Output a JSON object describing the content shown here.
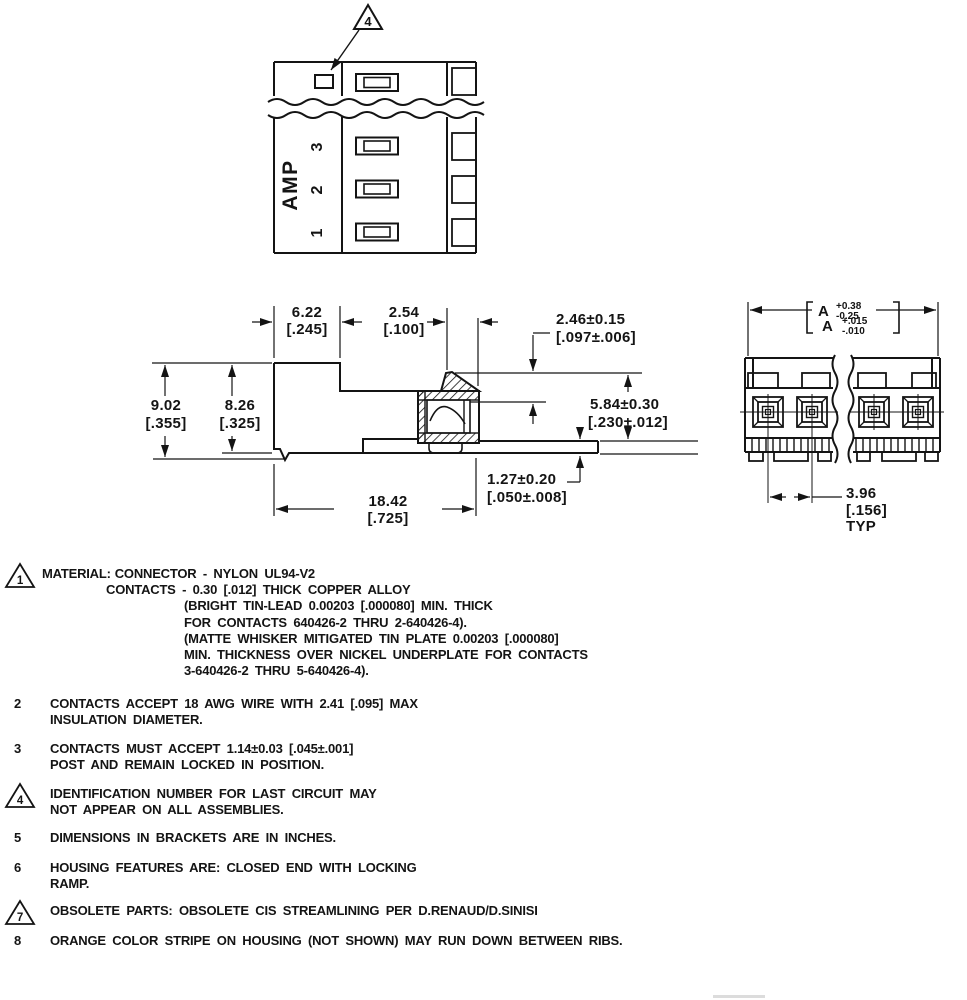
{
  "page": {
    "bg": "#ffffff",
    "ink": "#141414"
  },
  "top_view": {
    "callout": "4",
    "brand": "AMP",
    "pos3": "3",
    "pos2": "2",
    "pos1": "1"
  },
  "side_view": {
    "w_left_mm": "6.22",
    "w_left_in": "[.245]",
    "pitch_mm": "2.54",
    "pitch_in": "[.100]",
    "tab_mm": "2.46±0.15",
    "tab_in": "[.097±.006]",
    "h_overall_mm": "9.02",
    "h_overall_in": "[.355]",
    "h_body_mm": "8.26",
    "h_body_in": "[.325]",
    "contact_mm": "5.84±0.30",
    "contact_in": "[.230±.012]",
    "post_mm": "1.27±0.20",
    "post_in": "[.050±.008]",
    "len_mm": "18.42",
    "len_in": "[.725]"
  },
  "front_view": {
    "a_label_mm": "A",
    "a_plus_mm": "+0.38",
    "a_minus_mm": "-0.25",
    "a_label_in": "A",
    "a_plus_in": "+.015",
    "a_minus_in": "-.010",
    "pitch_mm": "3.96",
    "pitch_in": "[.156]",
    "pitch_typ": "TYP"
  },
  "notes": [
    {
      "num": "1",
      "flag": true,
      "label": "MATERIAL:",
      "lines": [
        "CONNECTOR - NYLON UL94-V2",
        "CONTACTS - 0.30 [.012] THICK COPPER ALLOY",
        "(BRIGHT TIN-LEAD 0.00203 [.000080] MIN. THICK",
        "FOR CONTACTS 640426-2 THRU 2-640426-4).",
        "(MATTE WHISKER MITIGATED TIN PLATE 0.00203 [.000080]",
        "MIN. THICKNESS OVER NICKEL UNDERPLATE FOR CONTACTS",
        "3-640426-2 THRU 5-640426-4)."
      ]
    },
    {
      "num": "2",
      "flag": false,
      "lines": [
        "CONTACTS ACCEPT 18 AWG WIRE WITH 2.41 [.095] MAX",
        "INSULATION DIAMETER."
      ]
    },
    {
      "num": "3",
      "flag": false,
      "lines": [
        "CONTACTS MUST ACCEPT 1.14±0.03 [.045±.001]",
        "POST AND REMAIN LOCKED IN POSITION."
      ]
    },
    {
      "num": "4",
      "flag": true,
      "lines": [
        "IDENTIFICATION NUMBER FOR LAST CIRCUIT MAY",
        "NOT APPEAR ON ALL ASSEMBLIES."
      ]
    },
    {
      "num": "5",
      "flag": false,
      "lines": [
        "DIMENSIONS IN BRACKETS ARE IN INCHES."
      ]
    },
    {
      "num": "6",
      "flag": false,
      "lines": [
        "HOUSING FEATURES ARE: CLOSED END WITH LOCKING",
        "RAMP."
      ]
    },
    {
      "num": "7",
      "flag": true,
      "lines": [
        "OBSOLETE PARTS: OBSOLETE CIS STREAMLINING PER D.RENAUD/D.SINISI"
      ]
    },
    {
      "num": "8",
      "flag": false,
      "lines": [
        "ORANGE COLOR STRIPE ON HOUSING (NOT SHOWN) MAY RUN DOWN BETWEEN RIBS."
      ]
    }
  ]
}
